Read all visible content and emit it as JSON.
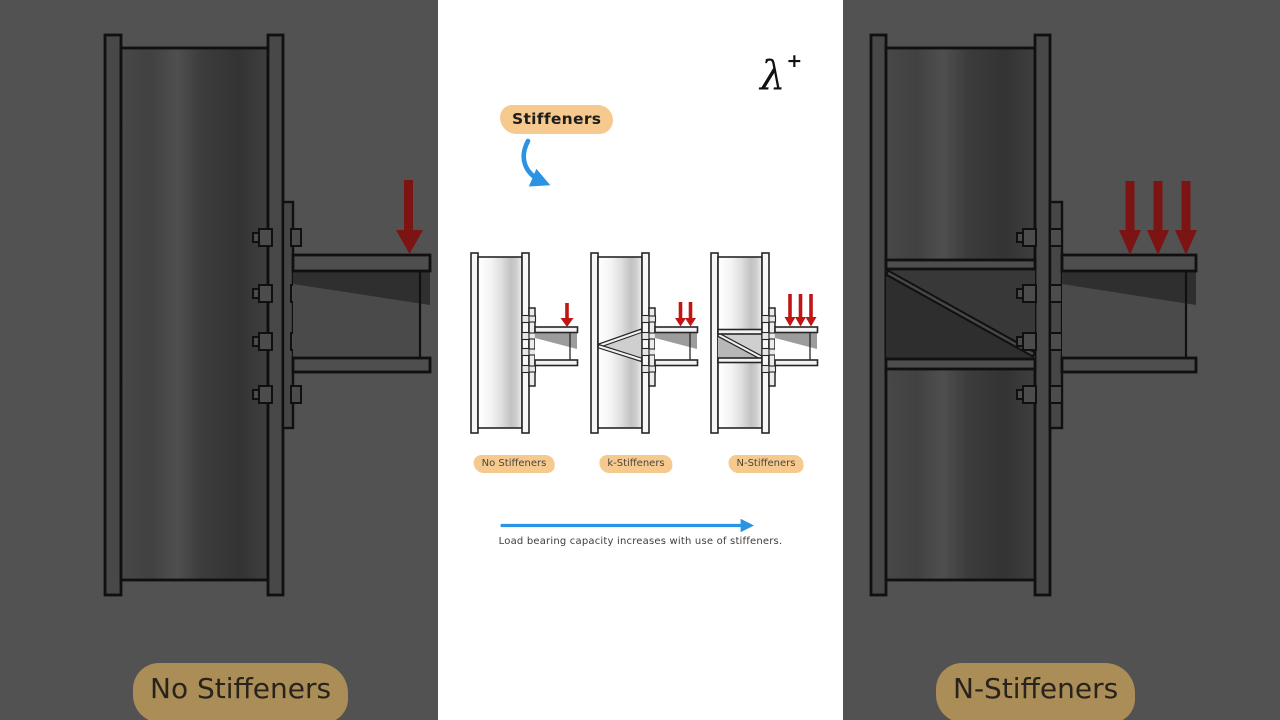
{
  "frame": {
    "type": "video-short-frame"
  },
  "colors": {
    "panel_bg": "#ffffff",
    "side_bg": "#525252",
    "accent_blue": "#2b93e3",
    "arrow_red": "#c11414",
    "arrow_red_dim": "#7d1414",
    "highlight": "#f6c98f",
    "highlight_dim": "#ab8d57",
    "ink": "#262626"
  },
  "logo": {
    "lambda": "λ",
    "plus": "+"
  },
  "annotation": {
    "label": "Stiffeners"
  },
  "diagrams": [
    {
      "label": "No Stiffeners",
      "load_arrows": 1
    },
    {
      "label": "k-Stiffeners",
      "load_arrows": 2
    },
    {
      "label": "N-Stiffeners",
      "load_arrows": 3
    }
  ],
  "caption": "Load bearing capacity increases with use of stiffeners.",
  "side_panels": {
    "left": {
      "label": "No Stiffeners"
    },
    "right": {
      "label": "N-Stiffeners"
    }
  }
}
